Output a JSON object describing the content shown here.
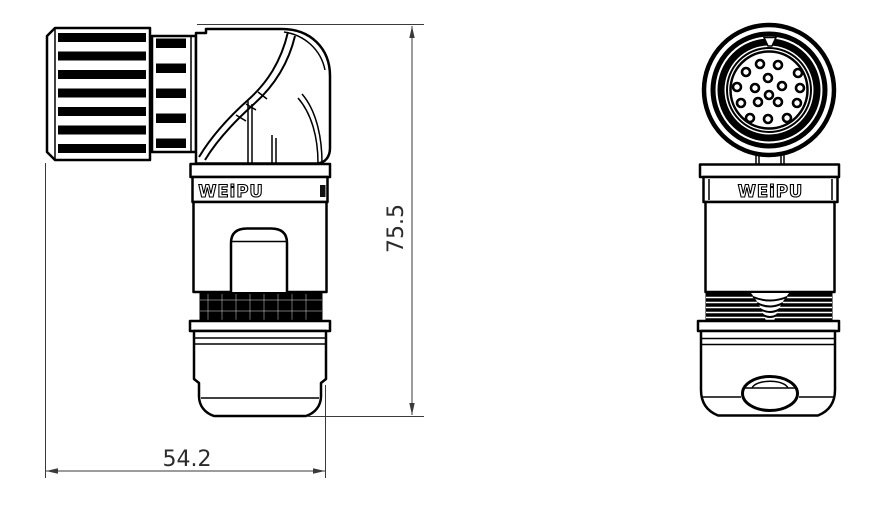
{
  "branding": {
    "side_view_label": "WEiPU",
    "front_view_label": "WEiPU"
  },
  "dimensions": {
    "width_mm": "54.2",
    "height_mm": "75.5"
  },
  "front_view": {
    "pin_count": 17,
    "pins": [
      {
        "x": 760,
        "y": 64
      },
      {
        "x": 778,
        "y": 65
      },
      {
        "x": 746,
        "y": 72
      },
      {
        "x": 798,
        "y": 73
      },
      {
        "x": 768,
        "y": 78
      },
      {
        "x": 737,
        "y": 87
      },
      {
        "x": 755,
        "y": 88
      },
      {
        "x": 782,
        "y": 86
      },
      {
        "x": 800,
        "y": 88
      },
      {
        "x": 769,
        "y": 95
      },
      {
        "x": 741,
        "y": 103
      },
      {
        "x": 758,
        "y": 102
      },
      {
        "x": 778,
        "y": 102
      },
      {
        "x": 797,
        "y": 103
      },
      {
        "x": 750,
        "y": 118
      },
      {
        "x": 768,
        "y": 119
      },
      {
        "x": 787,
        "y": 118
      }
    ]
  },
  "colors": {
    "background": "#ffffff",
    "line": "#000000",
    "dimension": "#3a3a3a"
  }
}
